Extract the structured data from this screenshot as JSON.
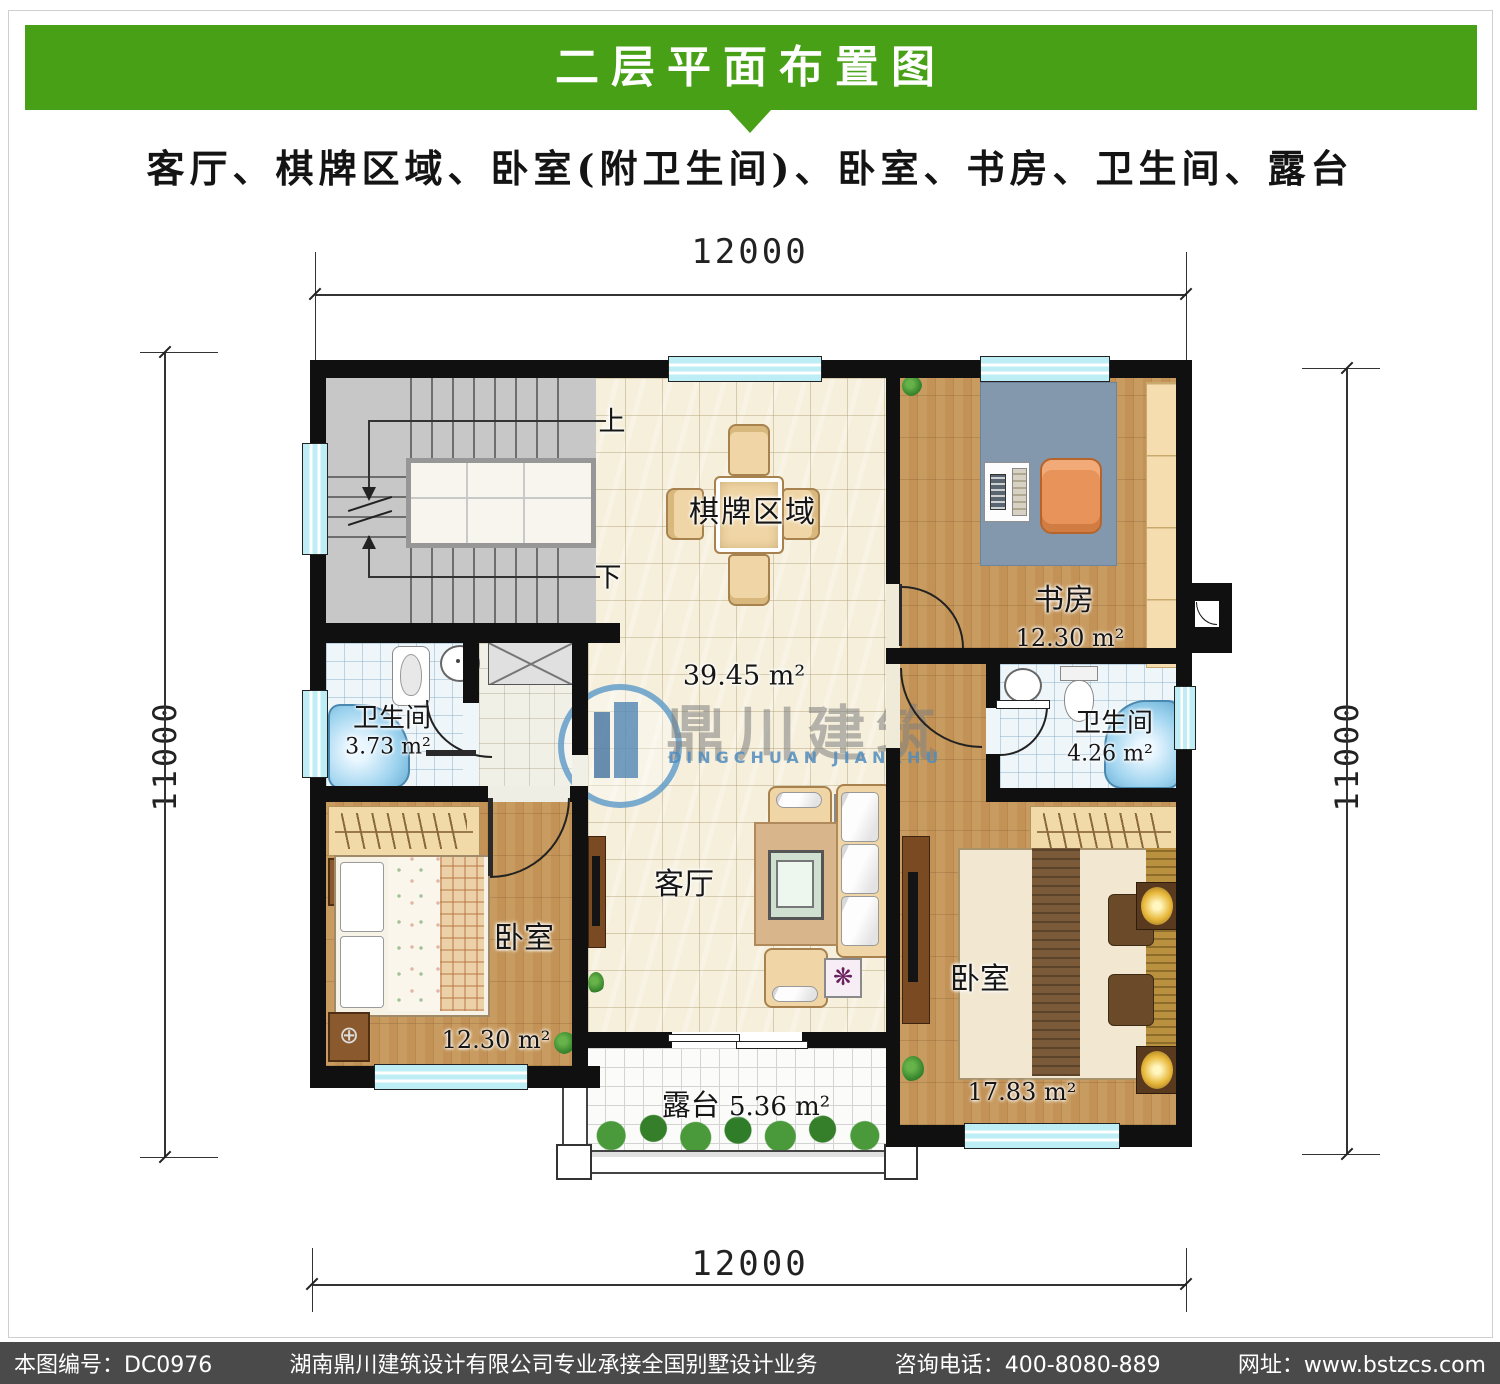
{
  "header": {
    "title": "二层平面布置图",
    "subtitle": "客厅、棋牌区域、卧室(附卫生间)、卧室、书房、卫生间、露台",
    "accent_color": "#48a016"
  },
  "dims": {
    "top": "12000",
    "bottom": "12000",
    "left": "11000",
    "right": "11000"
  },
  "stairs": {
    "up": "上",
    "down": "下"
  },
  "rooms": {
    "chess": {
      "name": "棋牌区域"
    },
    "study": {
      "name": "书房",
      "area": "12.30 m²"
    },
    "bath_left": {
      "name": "卫生间",
      "area": "3.73 m²"
    },
    "bath_right": {
      "name": "卫生间",
      "area": "4.26 m²"
    },
    "living": {
      "name": "客厅",
      "area": "39.45 m²"
    },
    "bedroom_left": {
      "name": "卧室",
      "area": "12.30 m²"
    },
    "bedroom_right": {
      "name": "卧室",
      "area": "17.83 m²"
    },
    "terrace": {
      "name": "露台",
      "area": "5.36 m²"
    }
  },
  "watermark": {
    "cn": "鼎川建筑",
    "en": "DINGCHUAN JIANZHU",
    "blue": "#4a90c4"
  },
  "footer": {
    "bg": "#4a4a4a",
    "sheet_no": "本图编号：DC0976",
    "company": "湖南鼎川建筑设计有限公司专业承接全国别墅设计业务",
    "phone": "咨询电话：400-8080-889",
    "website": "网址：www.bstzcs.com"
  },
  "colors": {
    "wall": "#101010",
    "window": "#bdeef6",
    "floor_tile": "#f5efdb",
    "wood": "#c49a5e"
  }
}
